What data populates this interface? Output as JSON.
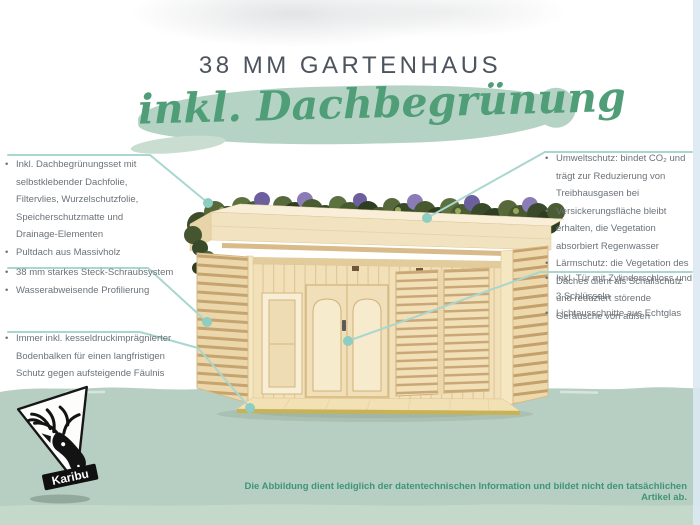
{
  "title": "38 MM GARTENHAUS",
  "banner": {
    "text": "inkl. Dachbegrünung"
  },
  "callouts": {
    "left": [
      {
        "items": [
          "Inkl. Dachbegrünungsset mit selbstklebender Dachfolie, Filtervlies, Wurzelschutzfolie, Speicherschutzmatte und Drainage-Elementen",
          "Pultdach aus Massivholz"
        ]
      },
      {
        "items": [
          "38 mm starkes Steck-Schraubsystem",
          "Wasserabweisende Profilierung"
        ]
      },
      {
        "items": [
          "Immer inkl. kesseldruckimprägnierter Bodenbalken für einen langfristigen Schutz gegen aufsteigende Fäulnis"
        ]
      }
    ],
    "right": [
      {
        "items": [
          "Umweltschutz: bindet CO₂ und trägt zur Reduzierung von Treibhausgasen bei",
          "Versickerungsfläche bleibt erhalten, die Vegetation absorbiert Regenwasser",
          "Lärmschutz: die Vegetation des Daches dient als Schallschutz und reduziert störende Geräusche von außen"
        ]
      },
      {
        "items": [
          "Inkl. Tür mit Zylinderschloss und 3 Schlüsseln",
          "Lichtausschnitte aus Echtglas"
        ]
      }
    ]
  },
  "logo": {
    "brand": "Karibu",
    "icon": "deer-head-logo"
  },
  "footer": {
    "disclaimer": "Die Abbildung dient lediglich der datentechnischen Information und bildet nicht den tatsächlichen Artikel ab."
  },
  "colors": {
    "banner_brush": "#b5d3c4",
    "script_green": "#4f9e78",
    "band_green": "#b6cfc2",
    "callout_line_teal": "#a9d6ce",
    "callout_dot_teal": "#8ecdc1",
    "text_gray": "#6b7278",
    "title_gray": "#4d545e",
    "disclaimer_green": "#3f9577",
    "wood_light": "#f2e3c0",
    "wood_mid": "#ecd7ab",
    "wood_dark": "#c6a470"
  }
}
